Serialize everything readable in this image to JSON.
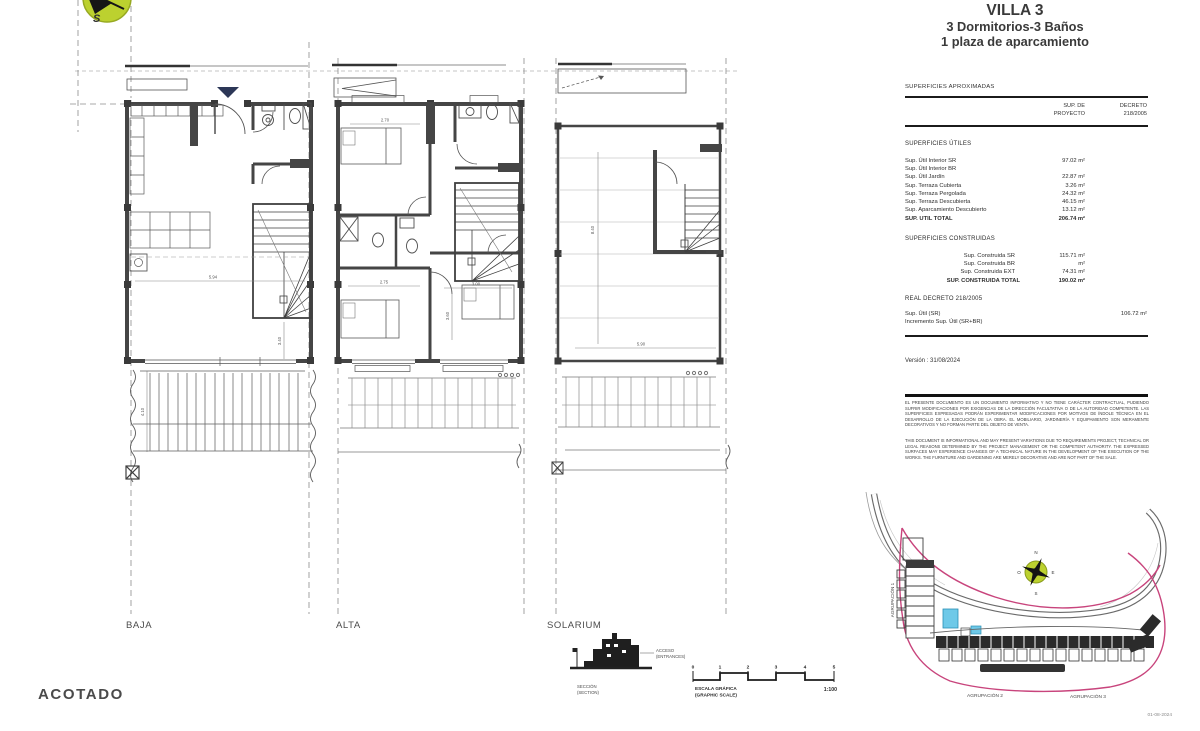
{
  "title": {
    "villa": "VILLA 3",
    "line2": "3 Dormitorios-3 Baños",
    "line3": "1 plaza de aparcamiento"
  },
  "table": {
    "caption": "SUPERFICIES APROXIMADAS",
    "col_project_l1": "SUP. DE",
    "col_project_l2": "PROYECTO",
    "col_decreto_l1": "DECRETO",
    "col_decreto_l2": "218/2005",
    "utiles_title": "SUPERFICIES ÚTILES",
    "utiles_rows": [
      {
        "label": "Sup. Útil Interior SR",
        "value": "97.02 m²"
      },
      {
        "label": "Sup. Útil Interior BR",
        "value": ""
      },
      {
        "label": "Sup. Útil Jardín",
        "value": "22.87 m²"
      },
      {
        "label": "Sup. Terraza Cubierta",
        "value": "3.26 m²"
      },
      {
        "label": "Sup. Terraza Pergolada",
        "value": "24.32 m²"
      },
      {
        "label": "Sup. Terraza Descubierta",
        "value": "46.15 m²"
      },
      {
        "label": "Sup. Aparcamiento Descubierto",
        "value": "13.12 m²"
      }
    ],
    "utiles_total": {
      "label": "SUP. UTIL TOTAL",
      "value": "206.74 m²"
    },
    "construidas_title": "SUPERFICIES CONSTRUIDAS",
    "construidas_rows": [
      {
        "label": "Sup. Construida SR",
        "value": "115.71 m²"
      },
      {
        "label": "Sup. Construida BR",
        "value": "m²"
      },
      {
        "label": "Sup. Construida EXT",
        "value": "74.31 m²"
      }
    ],
    "construidas_total": {
      "label": "SUP. CONSTRUIDA TOTAL",
      "value": "190.02 m²"
    },
    "decreto_title": "REAL DECRETO 218/2005",
    "decreto_rows": [
      {
        "label": "Sup. Útil (SR)",
        "value": "106.72 m²"
      },
      {
        "label": "Incremento Sup. Útil (SR+BR)",
        "value": ""
      }
    ],
    "version": "Versión : 31/08/2024"
  },
  "disclaimer": {
    "es": "EL PRESENTE DOCUMENTO ES UN DOCUMENTO INFORMATIVO Y NO TIENE CARÁCTER CONTRACTUAL, PUDIENDO SUFRIR MODIFICACIONES POR EXIGENCIAS DE LA DIRECCIÓN FACULTATIVA O DE LA AUTORIDAD COMPETENTE. LAS SUPERFICIES EXPRESADAS PODRÁN EXPERIMENTAR MODIFICACIONES POR MOTIVOS DE ÍNDOLE TÉCNICA EN EL DESARROLLO DE LA EJECUCIÓN DE LA OBRA. EL MOBILIARIO, JARDINERÍA Y EQUIPAMIENTO SON MERAMENTE DECORATIVOS Y NO FORMAN PARTE DEL OBJETO DE VENTA.",
    "en": "THIS DOCUMENT IS INFORMATIONAL AND MAY PRESENT VARIATIONS DUE TO REQUIREMENTS PROJECT, TECHNICAL OR LEGAL REASONS DETERMINED BY THE PROJECT MANAGEMENT OR THE COMPETENT AUTHORITY. THE EXPRESSED SURFACES MAY EXPERIENCE CHANGES OF A TECHNICAL NATURE IN THE DEVELOPMENT OF THE EXECUTION OF THE WORKS. THE FURNITURE AND GARDENING ARE MERELY DECORATIVE AND ARE NOT PART OF THE SALE."
  },
  "plans": {
    "drawing_title": "ACOTADO",
    "baja": {
      "label": "BAJA",
      "dims": [
        "5.94",
        "3.40",
        "4.10"
      ]
    },
    "alta": {
      "label": "ALTA",
      "dims": [
        "2.70",
        "2.75",
        "3.00",
        "3.60"
      ]
    },
    "solarium": {
      "label": "SOLARIUM",
      "dims": [
        "8.40",
        "5.90"
      ]
    }
  },
  "section": {
    "label_es": "SECCIÓN",
    "label_en": "(SECTION)",
    "access_es": "ACCESO",
    "access_en": "(ENTRANCES)"
  },
  "scalebar": {
    "ticks": [
      "0",
      "1",
      "2",
      "3",
      "4",
      "5"
    ],
    "label_es": "ESCALA GRÁFICA",
    "label_en": "(GRAPHIC SCALE)",
    "ratio": "1:100"
  },
  "siteplan": {
    "agrupacion1": "AGRUPACIÓN 1",
    "agrupacion2": "AGRUPACIÓN 2",
    "agrupacion3": "AGRUPACIÓN 3",
    "date": "01-08-2024",
    "compass": {
      "n": "N",
      "s": "S",
      "e": "E",
      "o": "O"
    }
  },
  "compass_main": {
    "s": "S"
  },
  "colors": {
    "accent_pink": "#c8447c",
    "compass_green": "#bcd12f",
    "highlight_cyan": "#6ec9e8",
    "entrance_navy": "#2c3757",
    "wall_gray": "#454545"
  }
}
